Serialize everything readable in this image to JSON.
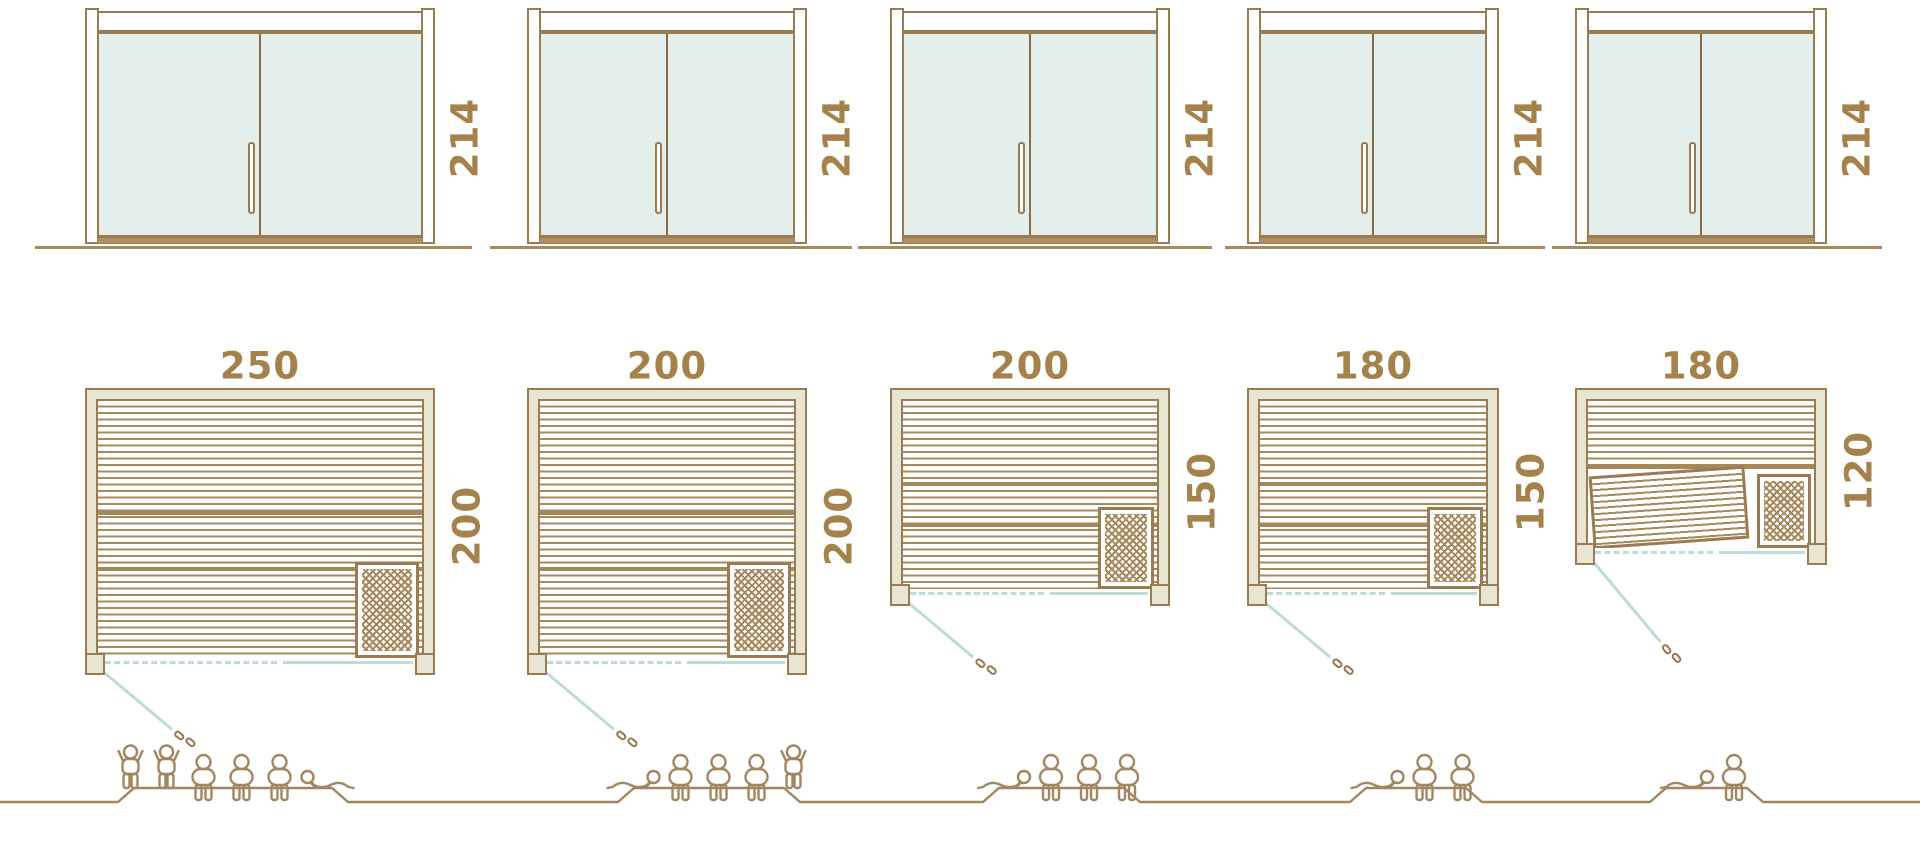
{
  "diagram": {
    "kind": "sauna-size-comparison",
    "rows": [
      "door-front-elevations",
      "floor-plans-top-view",
      "seating-capacity-figures"
    ]
  },
  "colors": {
    "outline_brown": "#9a7b52",
    "stripe_brown": "#a68a5e",
    "label_brown": "#a5824c",
    "frame_beige": "#e9e5d3",
    "glass_teal": "#e2efeb",
    "door_swing_teal": "#bedbd7",
    "background": "#ffffff"
  },
  "units": [
    {
      "door_height_cm": "214",
      "width_cm": "250",
      "depth_cm": "200",
      "capacity": 6,
      "figures": [
        "standing",
        "standing",
        "sitting",
        "sitting",
        "sitting",
        "lying-r"
      ]
    },
    {
      "door_height_cm": "214",
      "width_cm": "200",
      "depth_cm": "200",
      "capacity": 5,
      "figures": [
        "lying-l",
        "sitting",
        "sitting",
        "sitting",
        "standing"
      ]
    },
    {
      "door_height_cm": "214",
      "width_cm": "200",
      "depth_cm": "150",
      "capacity": 4,
      "figures": [
        "lying-l",
        "sitting",
        "sitting",
        "sitting"
      ]
    },
    {
      "door_height_cm": "214",
      "width_cm": "180",
      "depth_cm": "150",
      "capacity": 3,
      "figures": [
        "lying-l",
        "sitting",
        "sitting"
      ]
    },
    {
      "door_height_cm": "214",
      "width_cm": "180",
      "depth_cm": "120",
      "capacity": 2,
      "angled_bench": true,
      "figures": [
        "lying-l",
        "sitting"
      ]
    }
  ]
}
